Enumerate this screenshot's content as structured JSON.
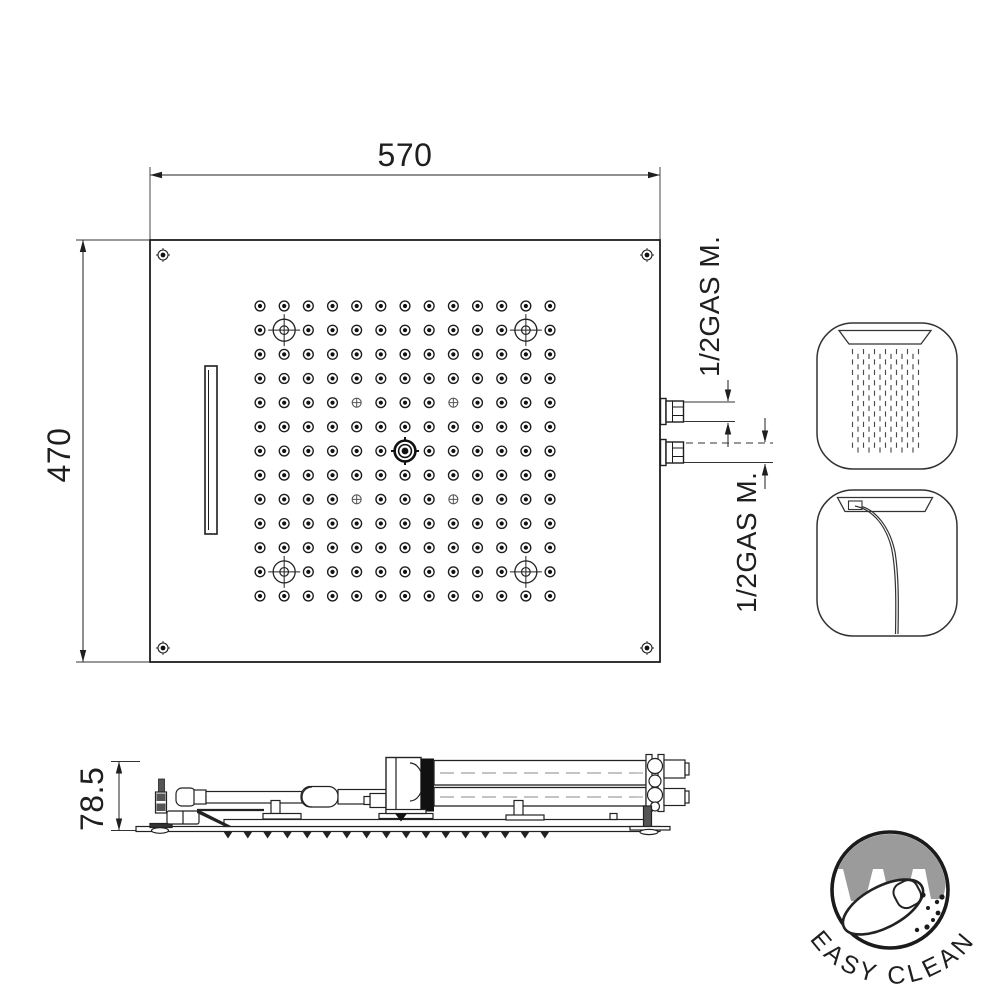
{
  "colors": {
    "line": "#1f1f1f",
    "accent_gray": "#9b9b9b"
  },
  "top_view": {
    "width_dim": "570",
    "height_dim": "470",
    "connection_top_label": "1/2GAS M.",
    "connection_bottom_label": "1/2GAS M.",
    "grid": {
      "cols": 13,
      "rows": 13,
      "origin_x": 260,
      "origin_y": 306,
      "step": 24.17,
      "led_positions": [
        [
          1,
          1
        ],
        [
          11,
          1
        ],
        [
          1,
          11
        ],
        [
          11,
          11
        ]
      ],
      "cross_positions": [
        [
          4,
          4
        ],
        [
          8,
          4
        ],
        [
          4,
          8
        ],
        [
          8,
          8
        ]
      ],
      "center_position": [
        6,
        6
      ]
    }
  },
  "side_view": {
    "height_dim": "78.5",
    "nozzles": {
      "count": 17,
      "x0": 228,
      "step": 19.8,
      "y": 831.5
    }
  },
  "icons": {
    "rain": {
      "name": "rain-spray-icon",
      "params": {
        "cols": 13,
        "x0": 852.5,
        "step": 5.5,
        "y0": 349,
        "y1": 448,
        "dash": 5.2,
        "gap": 5.2,
        "offset": 4.8
      }
    },
    "waterfall": {
      "name": "waterfall-spray-icon"
    }
  },
  "logo": {
    "text": "EASY CLEAN"
  }
}
